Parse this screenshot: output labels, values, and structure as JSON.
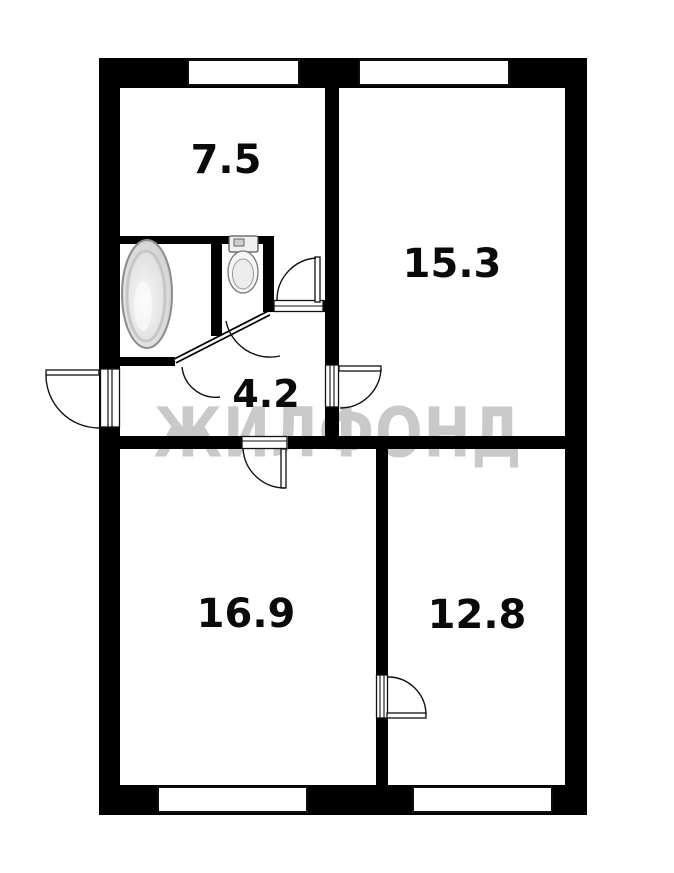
{
  "floorplan": {
    "type": "apartment-floor-plan",
    "watermark": "ЖИЛФОНД",
    "rooms": [
      {
        "id": "room-top-left",
        "area_label": "7.5"
      },
      {
        "id": "room-top-right",
        "area_label": "15.3"
      },
      {
        "id": "hallway",
        "area_label": "4.2"
      },
      {
        "id": "room-bottom-left",
        "area_label": "16.9"
      },
      {
        "id": "room-bottom-right",
        "area_label": "12.8"
      }
    ],
    "fixtures": [
      {
        "id": "bathtub"
      },
      {
        "id": "toilet"
      }
    ],
    "counts": {
      "windows": 4,
      "swing_doors": 7
    },
    "colors": {
      "walls": "#000000",
      "background": "#ffffff",
      "watermark": "#c9c9c9",
      "labels": "#0a0a0a",
      "fixture_fill": "#ececec"
    }
  }
}
